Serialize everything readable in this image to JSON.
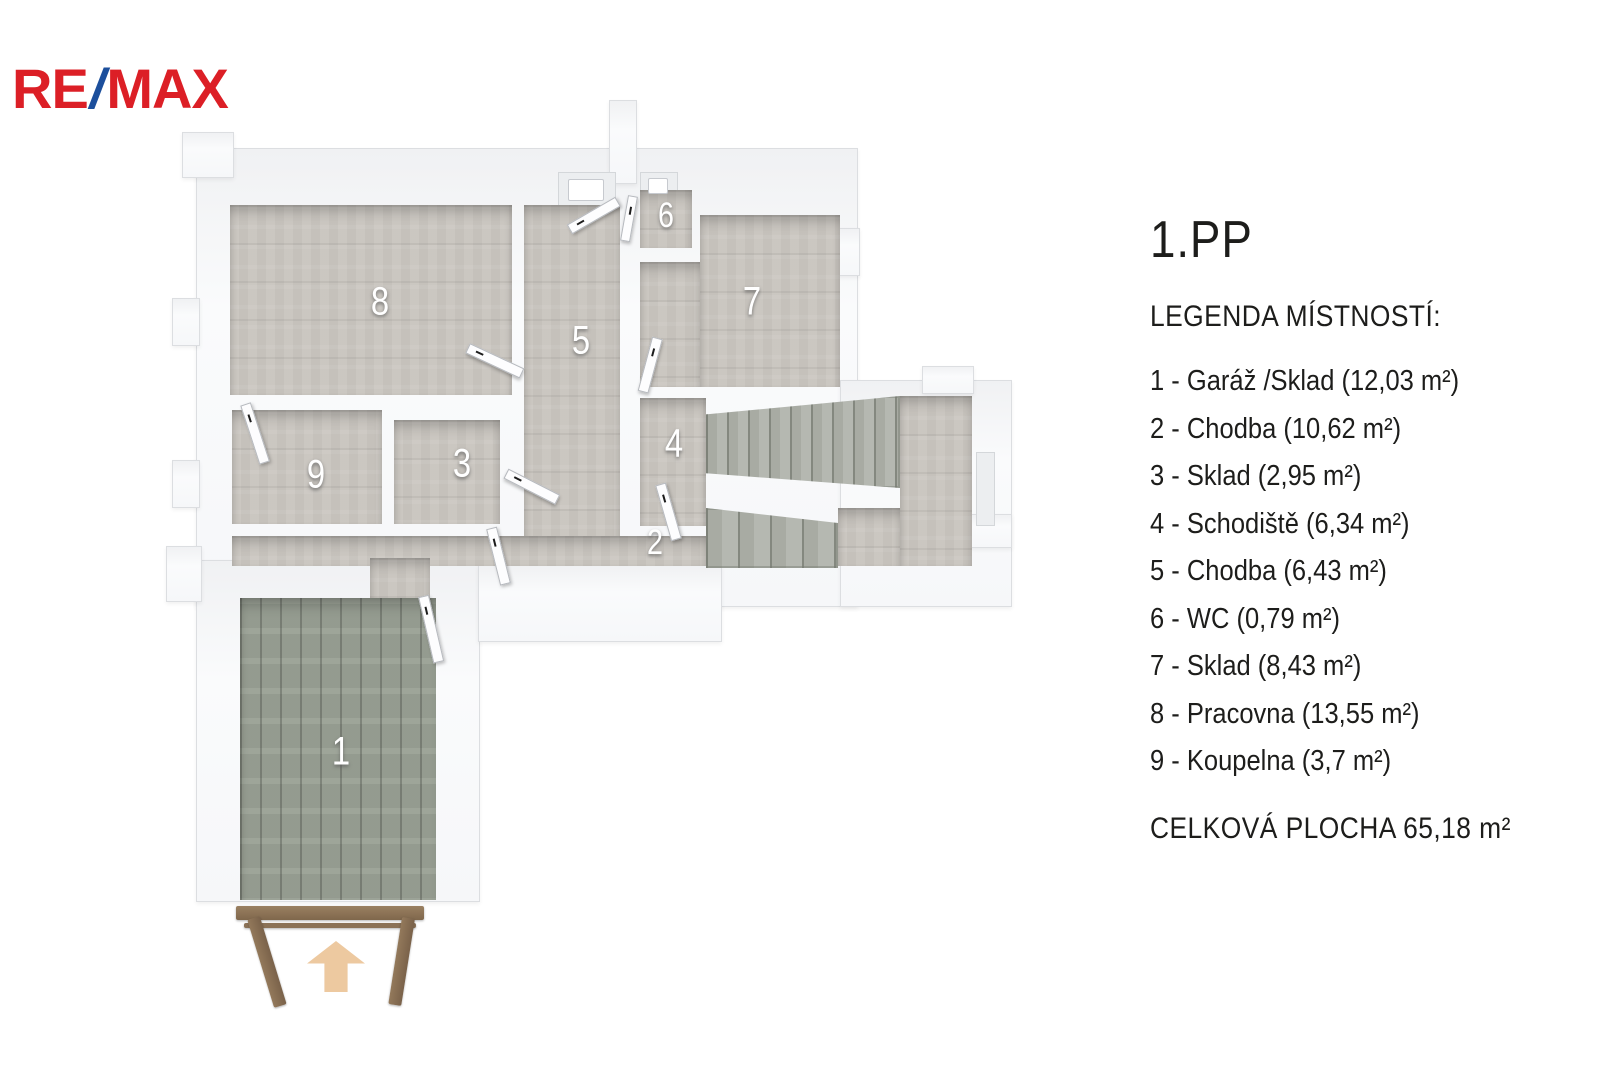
{
  "brand": {
    "name": "RE/MAX",
    "re": "RE",
    "slash": "/",
    "max": "MAX"
  },
  "panel": {
    "floor_title": "1.PP",
    "legend_heading": "LEGENDA MÍSTNOSTÍ:",
    "rooms": [
      "1 - Garáž /Sklad (12,03 m²)",
      "2 - Chodba (10,62 m²)",
      "3 - Sklad (2,95 m²)",
      "4 - Schodiště (6,34 m²)",
      "5 - Chodba (6,43 m²)",
      "6 - WC (0,79 m²)",
      "7 - Sklad (8,43 m²)",
      "8 - Pracovna (13,55 m²)",
      "9 - Koupelna (3,7 m²)"
    ],
    "total_area": "CELKOVÁ PLOCHA 65,18 m²"
  },
  "plan": {
    "room_numbers": {
      "r1": "1",
      "r2": "2",
      "r3": "3",
      "r4": "4",
      "r5": "5",
      "r6": "6",
      "r7": "7",
      "r8": "8",
      "r9": "9"
    }
  },
  "colors": {
    "brand_red": "#dc1f26",
    "brand_blue": "#1c4f9c",
    "wall": "#f8f9fa",
    "floor": "#c9c5bf",
    "garage_floor": "#99a094",
    "stairs": "#a8aba3",
    "arrow": "#edc9a0",
    "wood_frame": "#8a7157",
    "text": "#1d1d1b",
    "room_label": "#ffffff"
  }
}
